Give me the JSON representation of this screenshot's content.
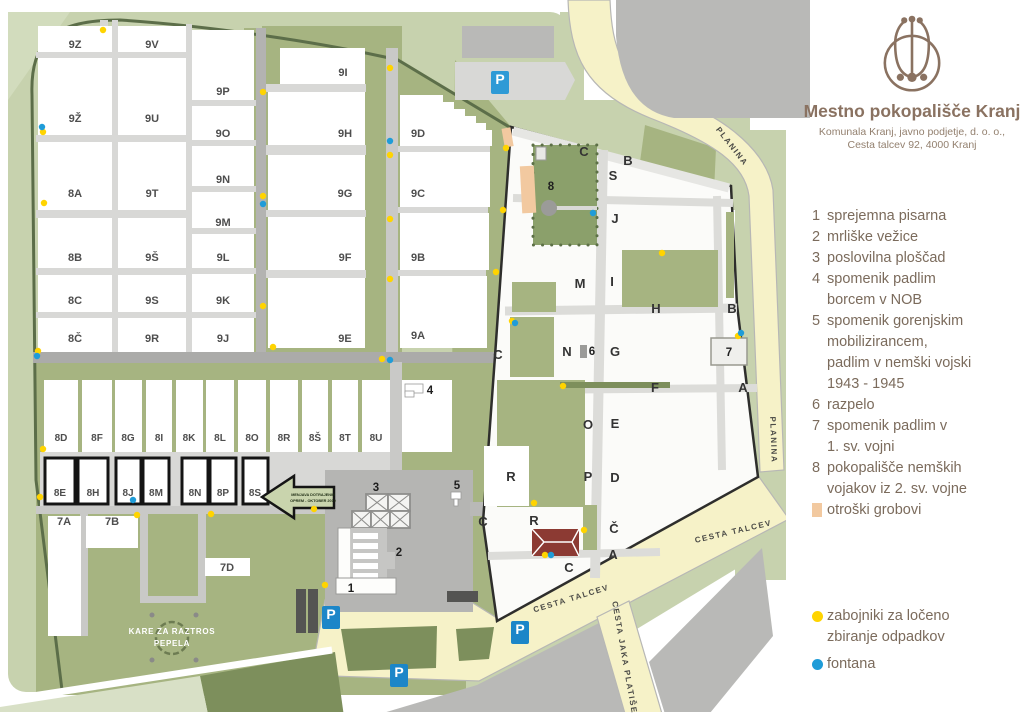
{
  "brand": {
    "title": "Mestno pokopališče Kranj",
    "subtitle_line1": "Komunala Kranj, javno podjetje, d. o. o.,",
    "subtitle_line2": "Cesta talcev 92, 4000 Kranj"
  },
  "legend": {
    "items": [
      {
        "marker": "1",
        "lines": [
          "sprejemna pisarna"
        ]
      },
      {
        "marker": "2",
        "lines": [
          "mrliške vežice"
        ]
      },
      {
        "marker": "3",
        "lines": [
          "poslovilna ploščad"
        ]
      },
      {
        "marker": "4",
        "lines": [
          "spomenik padlim",
          "borcem v NOB"
        ]
      },
      {
        "marker": "5",
        "lines": [
          "spomenik gorenjskim",
          "mobilizirancem,",
          "padlim v nemški vojski",
          "1943 - 1945"
        ]
      },
      {
        "marker": "6",
        "lines": [
          "razpelo"
        ]
      },
      {
        "marker": "7",
        "lines": [
          "spomenik padlim v",
          "1. sv. vojni"
        ]
      },
      {
        "marker": "8",
        "lines": [
          "pokopališče nemških",
          "vojakov iz 2. sv. vojne"
        ]
      },
      {
        "marker": "swatch",
        "lines": [
          "otroški grobovi"
        ]
      }
    ],
    "waste_lines": [
      "zabojniki za ločeno",
      "zbiranje odpadkov"
    ],
    "fountain_lines": [
      "fontana"
    ]
  },
  "map": {
    "labels": {
      "z9Z": "9Z",
      "z9V": "9V",
      "z9Zh": "9Ž",
      "z9U": "9U",
      "z8A": "8A",
      "z9T": "9T",
      "z8B": "8B",
      "z9Sh": "9Š",
      "z8C": "8C",
      "z9S": "9S",
      "z8Ch": "8Č",
      "z9R": "9R",
      "z9P": "9P",
      "z9O": "9O",
      "z9N": "9N",
      "z9M": "9M",
      "z9L": "9L",
      "z9K": "9K",
      "z9J": "9J",
      "z9I": "9I",
      "z9H": "9H",
      "z9G": "9G",
      "z9F": "9F",
      "z9E": "9E",
      "z9D": "9D",
      "z9C": "9C",
      "z9B": "9B",
      "z9A": "9A",
      "c8D": "8D",
      "c8F": "8F",
      "c8G": "8G",
      "c8I": "8I",
      "c8K": "8K",
      "c8L": "8L",
      "c8O": "8O",
      "c8R": "8R",
      "c8Sh": "8Š",
      "c8T": "8T",
      "c8U": "8U",
      "b8E": "8E",
      "b8H": "8H",
      "b8J": "8J",
      "b8M": "8M",
      "b8N": "8N",
      "b8P": "8P",
      "b8S": "8S",
      "z7A": "7A",
      "z7B": "7B",
      "z7D": "7D",
      "n1": "1",
      "n2": "2",
      "n3": "3",
      "n4": "4",
      "n5": "5",
      "n6": "6",
      "n7": "7",
      "n8": "8",
      "oC1": "C",
      "oB1": "B",
      "oS": "S",
      "oJ": "J",
      "oM": "M",
      "oI": "I",
      "oH": "H",
      "oB2": "B",
      "oN": "N",
      "oG": "G",
      "oF": "F",
      "oA1": "A",
      "oC2": "C",
      "oO": "O",
      "oE": "E",
      "oP": "P",
      "oD": "D",
      "oR1": "R",
      "oR2": "R",
      "oCh": "Č",
      "oA2": "A",
      "oC3": "C",
      "oC4": "C",
      "stPlanina1": "PLANINA",
      "stPlanina2": "PLANINA",
      "stCT1": "CESTA TALCEV",
      "stCT2": "CESTA TALCEV",
      "stCJP": "CESTA JAKA PLATIŠE",
      "kare1": "KARE ZA RAZTROS",
      "kare2": "PEPELA",
      "arrow1": "MENJAVA DOTRAJENIH",
      "arrow2": "OPREM - OKTOBER 2019",
      "p1": "P",
      "p2": "P",
      "p3": "P",
      "p4": "P"
    },
    "colors": {
      "sage": "#c7d2ae",
      "pale_sage": "#d8e0c6",
      "olive": "#a6b481",
      "dark_olive": "#7d8f5c",
      "hedge_line": "#5c6e49",
      "road_light": "#d8d8d6",
      "road_mid": "#c9c9c7",
      "road_dark": "#ababa9",
      "asphalt": "#b9b9b7",
      "yellow_road": "#f6f2c8",
      "peach": "#f2c9a0",
      "german_green": "#8ba06b",
      "waste_dot": "#ffd400",
      "fountain_dot": "#1f9cd8",
      "parking_blue": "#1c86c8",
      "brand_brown": "#8a7261",
      "red_building": "#8c3a33",
      "boundary_black": "#2e2e2c"
    }
  }
}
